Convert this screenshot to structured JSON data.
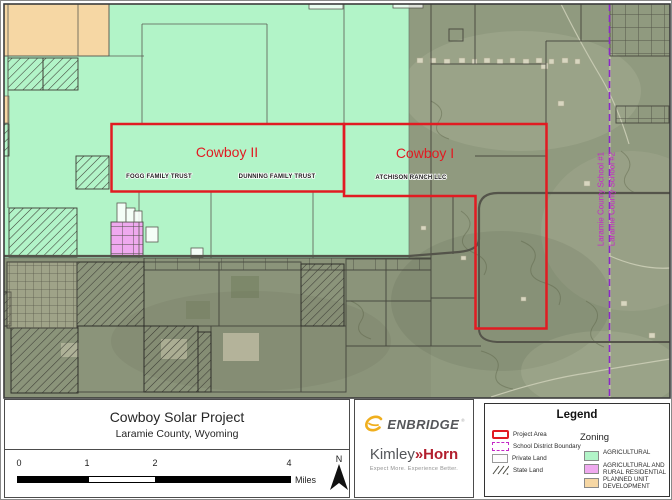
{
  "colors": {
    "project_area_red": "#e11b22",
    "school_boundary_purple": "#8c28c8",
    "school_label_magenta": "#c428c8",
    "agricultural_green": "#b2f4c8",
    "ag_rural_residential_pink": "#efa9ef",
    "planned_unit_dev_orange": "#f6d7a4",
    "enbridge_gray": "#55565a",
    "enbridge_yellow": "#f0af1e",
    "kimley_gray": "#54565a",
    "kimley_red": "#b21f2e"
  },
  "map": {
    "project_labels": [
      {
        "label": "Cowboy II"
      },
      {
        "label": "Cowboy I"
      }
    ],
    "parcel_labels": [
      {
        "label": "FOGG FAMILY TRUST"
      },
      {
        "label": "DUNNING FAMILY TRUST"
      },
      {
        "label": "ATCHISON RANCH LLC"
      }
    ],
    "school_district_labels": [
      {
        "label": "Laramie County School #1"
      },
      {
        "label": "Laramie County School #2"
      }
    ]
  },
  "title_block": {
    "title": "Cowboy Solar Project",
    "subtitle": "Laramie County, Wyoming"
  },
  "scale_bar": {
    "ticks": [
      "0",
      "1",
      "2",
      "4"
    ],
    "unit": "Miles",
    "north_label": "N"
  },
  "logos": {
    "enbridge": "ENBRIDGE",
    "enbridge_mark": "®",
    "kimley_part1": "Kimley",
    "kimley_sep": "»",
    "kimley_part2": "Horn",
    "kimley_tagline": "Expect More. Experience Better."
  },
  "legend": {
    "title": "Legend",
    "items": [
      {
        "label": "Project Area"
      },
      {
        "label": "School District Boundary"
      },
      {
        "label": "Private Land"
      },
      {
        "label": "State Land"
      }
    ],
    "zoning_title": "Zoning",
    "zoning": [
      {
        "label": "AGRICULTURAL"
      },
      {
        "label": "AGRICULTURAL AND RURAL RESIDENTIAL"
      },
      {
        "label": "PLANNED UNIT DEVELOPMENT"
      }
    ]
  }
}
